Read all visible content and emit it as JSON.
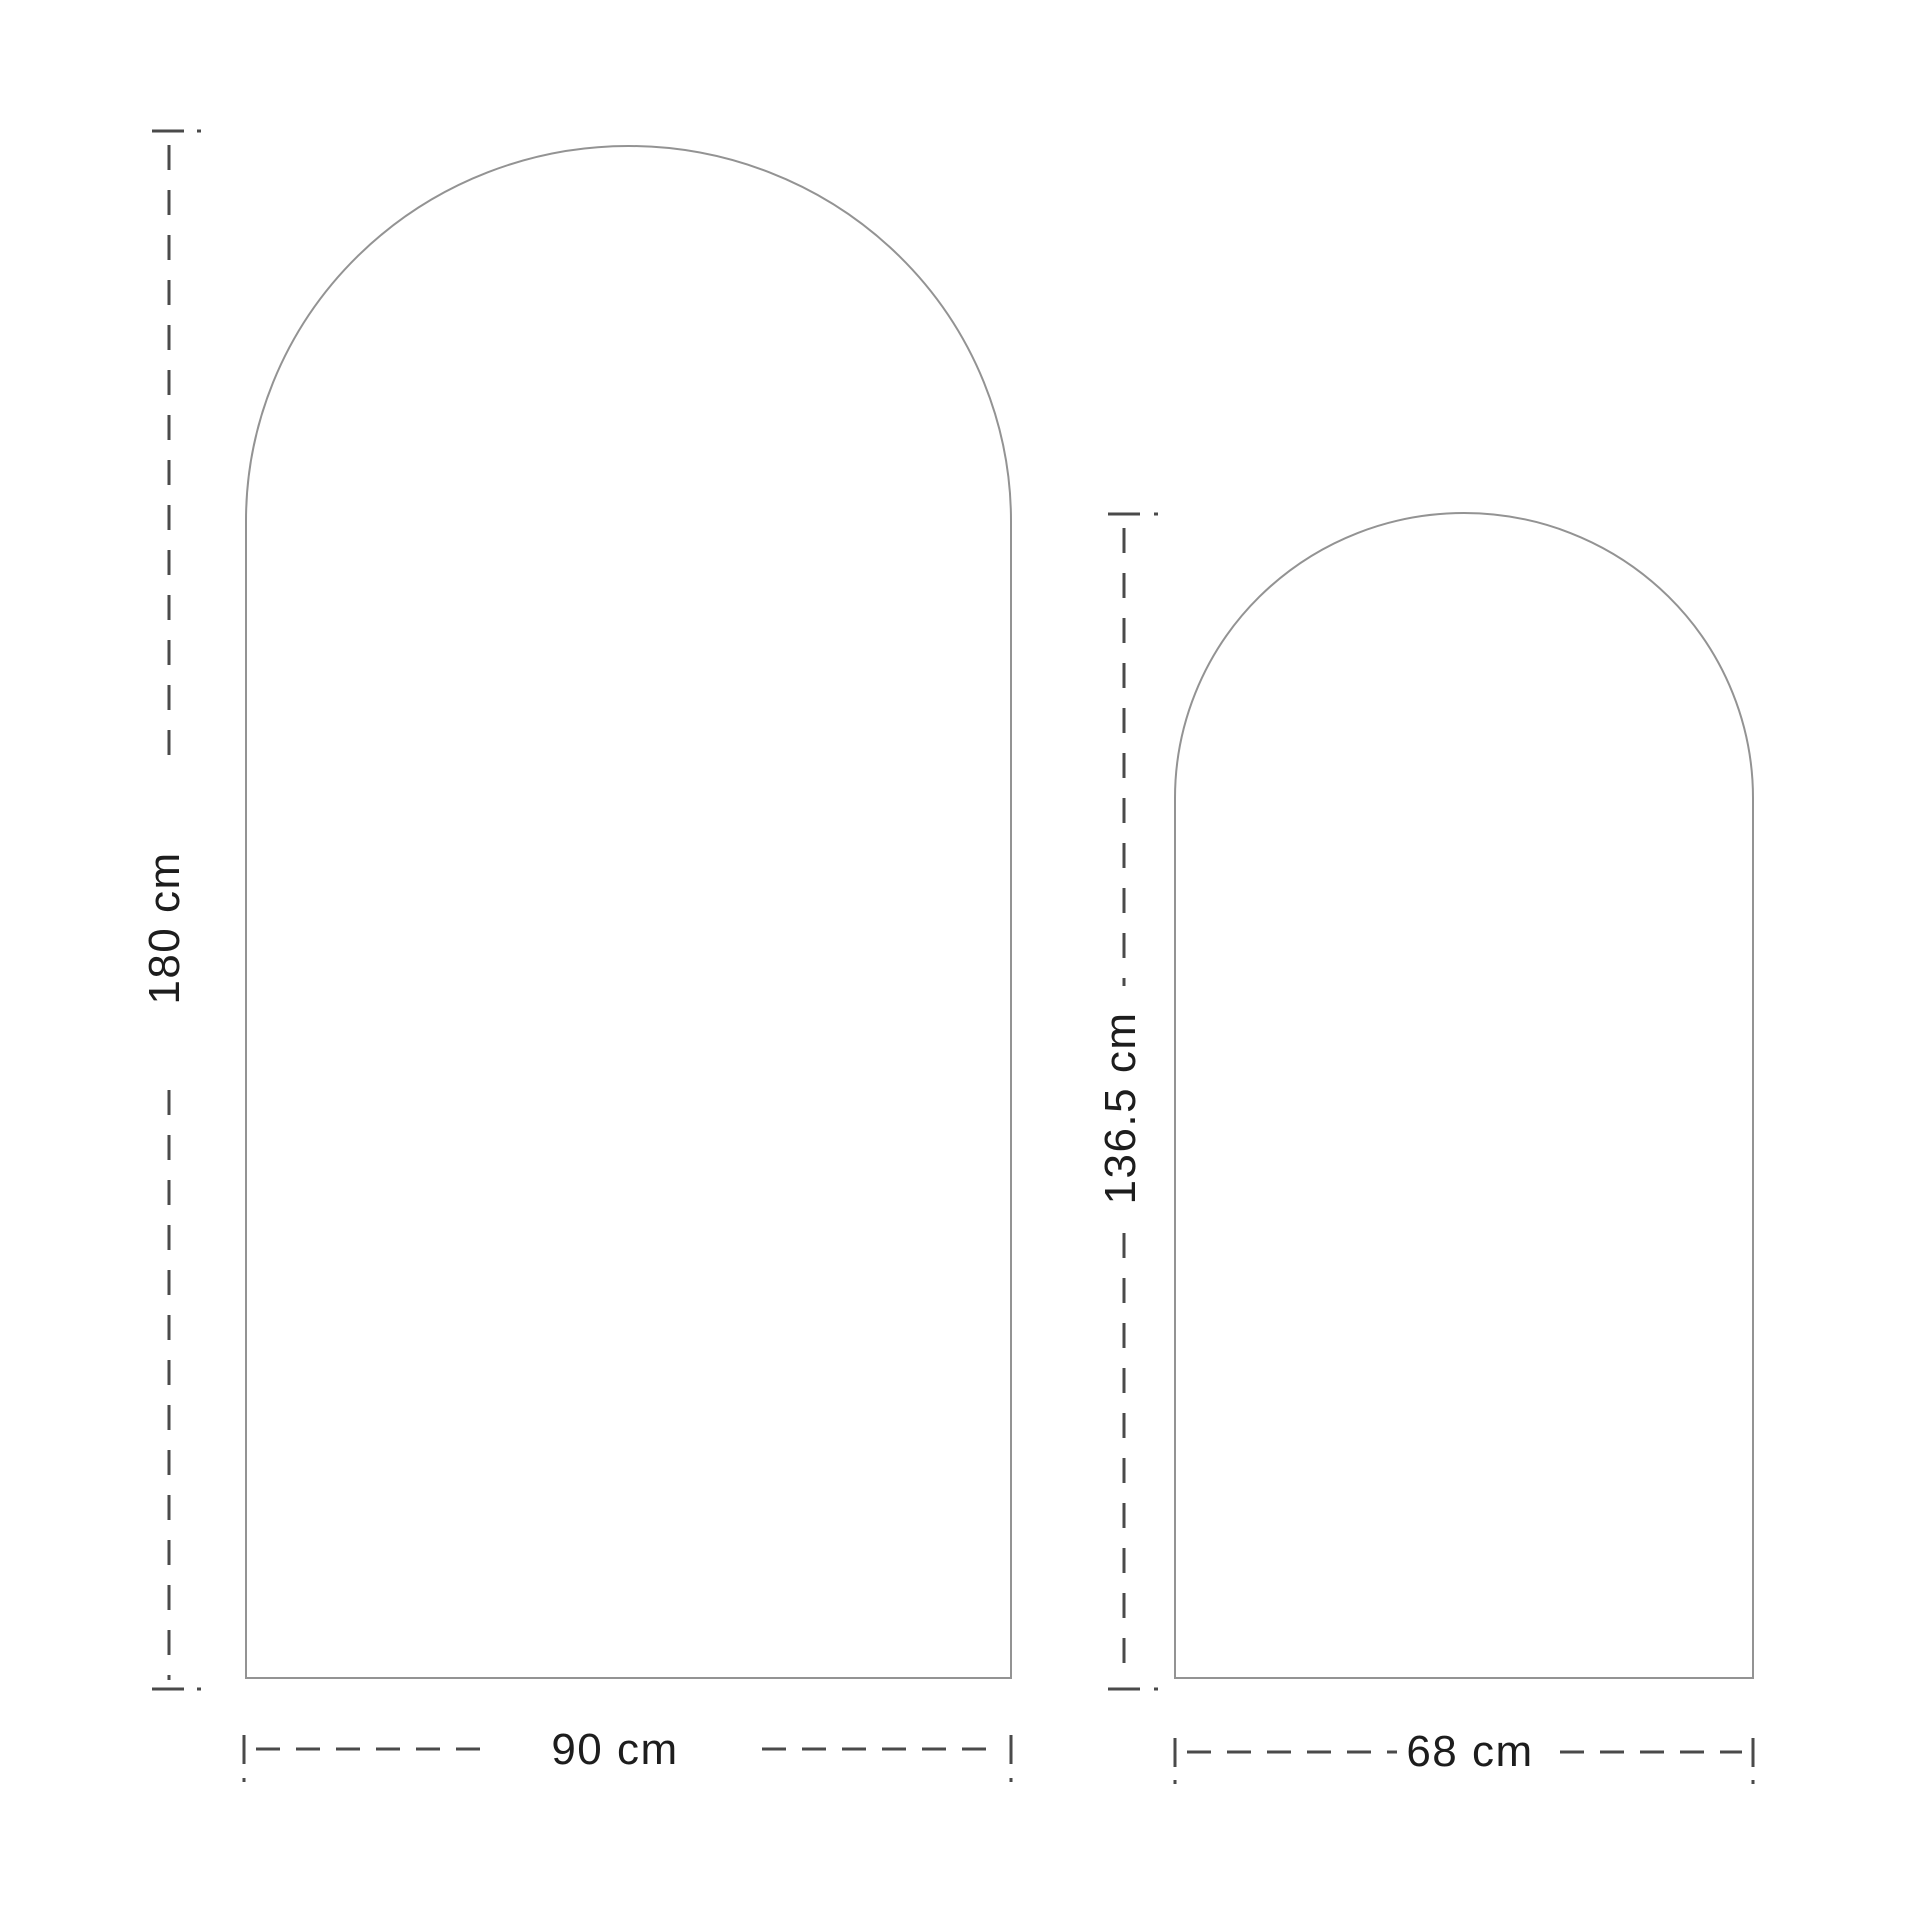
{
  "diagram": {
    "type": "dimension-diagram",
    "unit": "cm",
    "shapes": [
      {
        "id": "large-arch",
        "shape": "arched-panel",
        "height_cm": 180,
        "width_cm": 90,
        "height_label": "180 cm",
        "width_label": "90 cm"
      },
      {
        "id": "small-arch",
        "shape": "arched-panel",
        "height_cm": 136.5,
        "width_cm": 68,
        "height_label": "136.5 cm",
        "width_label": "68 cm"
      }
    ],
    "colors": {
      "background": "#ffffff",
      "outline": "#939393",
      "dimension_line": "#4a4a4a",
      "label_text": "#1d1d1d"
    }
  }
}
